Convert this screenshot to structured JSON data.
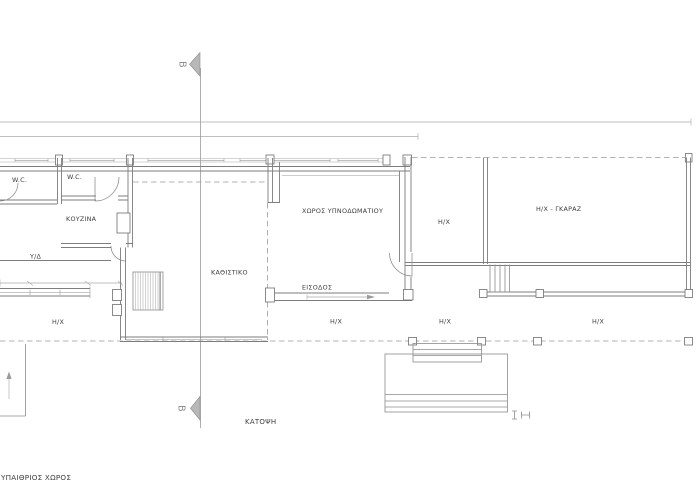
{
  "plan": {
    "title": "ΚΑΤΟΨΗ",
    "section_label": "B",
    "site_label": "ΥΠΑΙΘΡΙΟΣ ΧΩΡΟΣ",
    "rooms": {
      "wc1": "W.C.",
      "wc2": "W.C.",
      "kitchen": "ΚΟΥΖΙΝΑ",
      "bedroom_closet": "Υ/Δ",
      "bedroom_area": "ΧΩΡΟΣ ΥΠΝΟΔΩΜΑΤΙΟΥ",
      "living": "ΚΑΘΙΣΤΙΚΟ",
      "entrance": "ΕΙΣΟΔΟΣ",
      "garage": "Η/Χ - ΓΚΑΡΑΖ"
    },
    "semi_open_labels": [
      "Η/Χ",
      "Η/Χ",
      "Η/Χ",
      "Η/Χ",
      "Η/Χ"
    ],
    "colors": {
      "background": "#ffffff",
      "wall_line": "#7d7d7d",
      "light_line": "#9a9a9a",
      "text": "#3d3d3d",
      "section_marker_fill": "#b8b8b8"
    }
  }
}
